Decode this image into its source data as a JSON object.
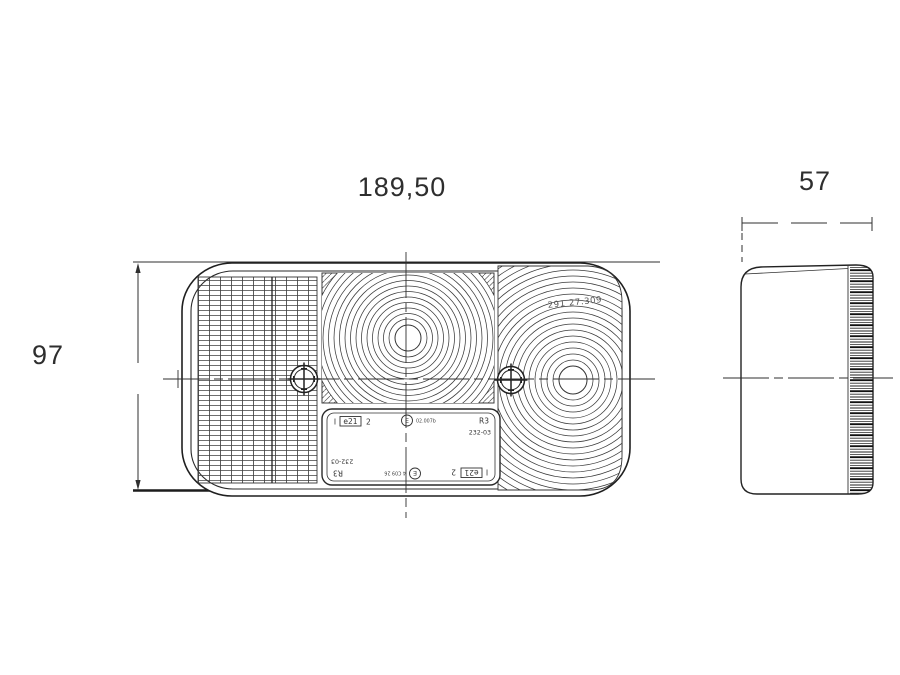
{
  "page": {
    "background": "#ffffff",
    "ink": "#2a2a2a"
  },
  "dimensions": {
    "front_width": "189,50",
    "front_height": "97",
    "side_depth": "57"
  },
  "front_view": {
    "lens_marking": "291 27.309",
    "approval_plate": {
      "row_top": {
        "tick": "I",
        "country_box": "e21",
        "category": "2",
        "e_mark": "E",
        "code": "02.007b",
        "type": "R3",
        "regulation": "232-03"
      },
      "row_bottom": {
        "tick": "I",
        "country_box": "e21",
        "category": "2",
        "e_mark": "E",
        "code": "4 C09 26",
        "type": "R3",
        "regulation": "232-03"
      }
    }
  }
}
